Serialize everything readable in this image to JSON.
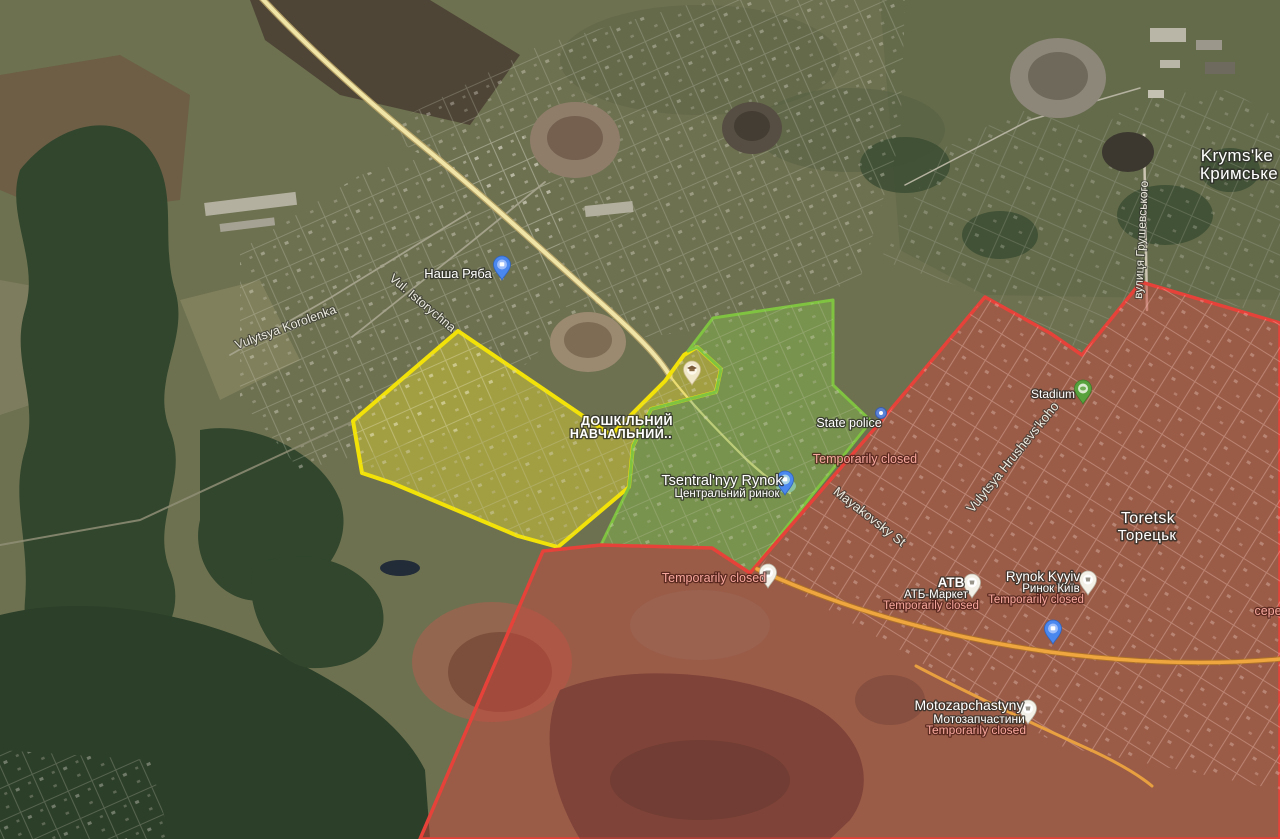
{
  "map_labels": {
    "settlements": [
      {
        "latin": "Kryms'ke",
        "cyrillic": "Кримське"
      },
      {
        "latin": "Toretsk",
        "cyrillic": "Торецьк"
      }
    ],
    "streets": [
      "Vulytsya Korolenka",
      "Vul. Istorychna",
      "вулиця Грушевського",
      "Vulytsya Hrushevs'koho",
      "Mayakovsky St"
    ],
    "pois": [
      {
        "name": "Наша Ряба"
      },
      {
        "line1": "ДОШКІЛЬНИЙ",
        "line2": "НАВЧАЛЬНИЙ.."
      },
      {
        "name": "Tsentral'nyy Rynok",
        "cyrillic": "Центральний ринок"
      },
      {
        "name": "State police"
      },
      {
        "name": "Stadium"
      },
      {
        "name": "ATB",
        "cyrillic": "АТБ-Маркет",
        "status": "Temporarily closed"
      },
      {
        "name": "Rynok Kyyiv",
        "cyrillic": "Ринок Київ",
        "status": "Temporarily closed"
      },
      {
        "name": "Motozapchastyny",
        "cyrillic": "Мотозапчастини",
        "status": "Temporarily closed"
      }
    ],
    "closed_generic": "Temporarily closed",
    "edge_fragment": "сере"
  },
  "zones": {
    "yellow_outline": "#f2e208",
    "yellow_fill": "rgba(236,224,48,0.42)",
    "green_outline": "#7fc341",
    "green_fill": "rgba(132,188,74,0.45)",
    "red_outline": "#e6423a",
    "red_fill": "rgba(200,72,62,0.5)"
  },
  "roads": {
    "main_road_color": "#f0e4a6",
    "orange_road_color": "#efa63e"
  }
}
